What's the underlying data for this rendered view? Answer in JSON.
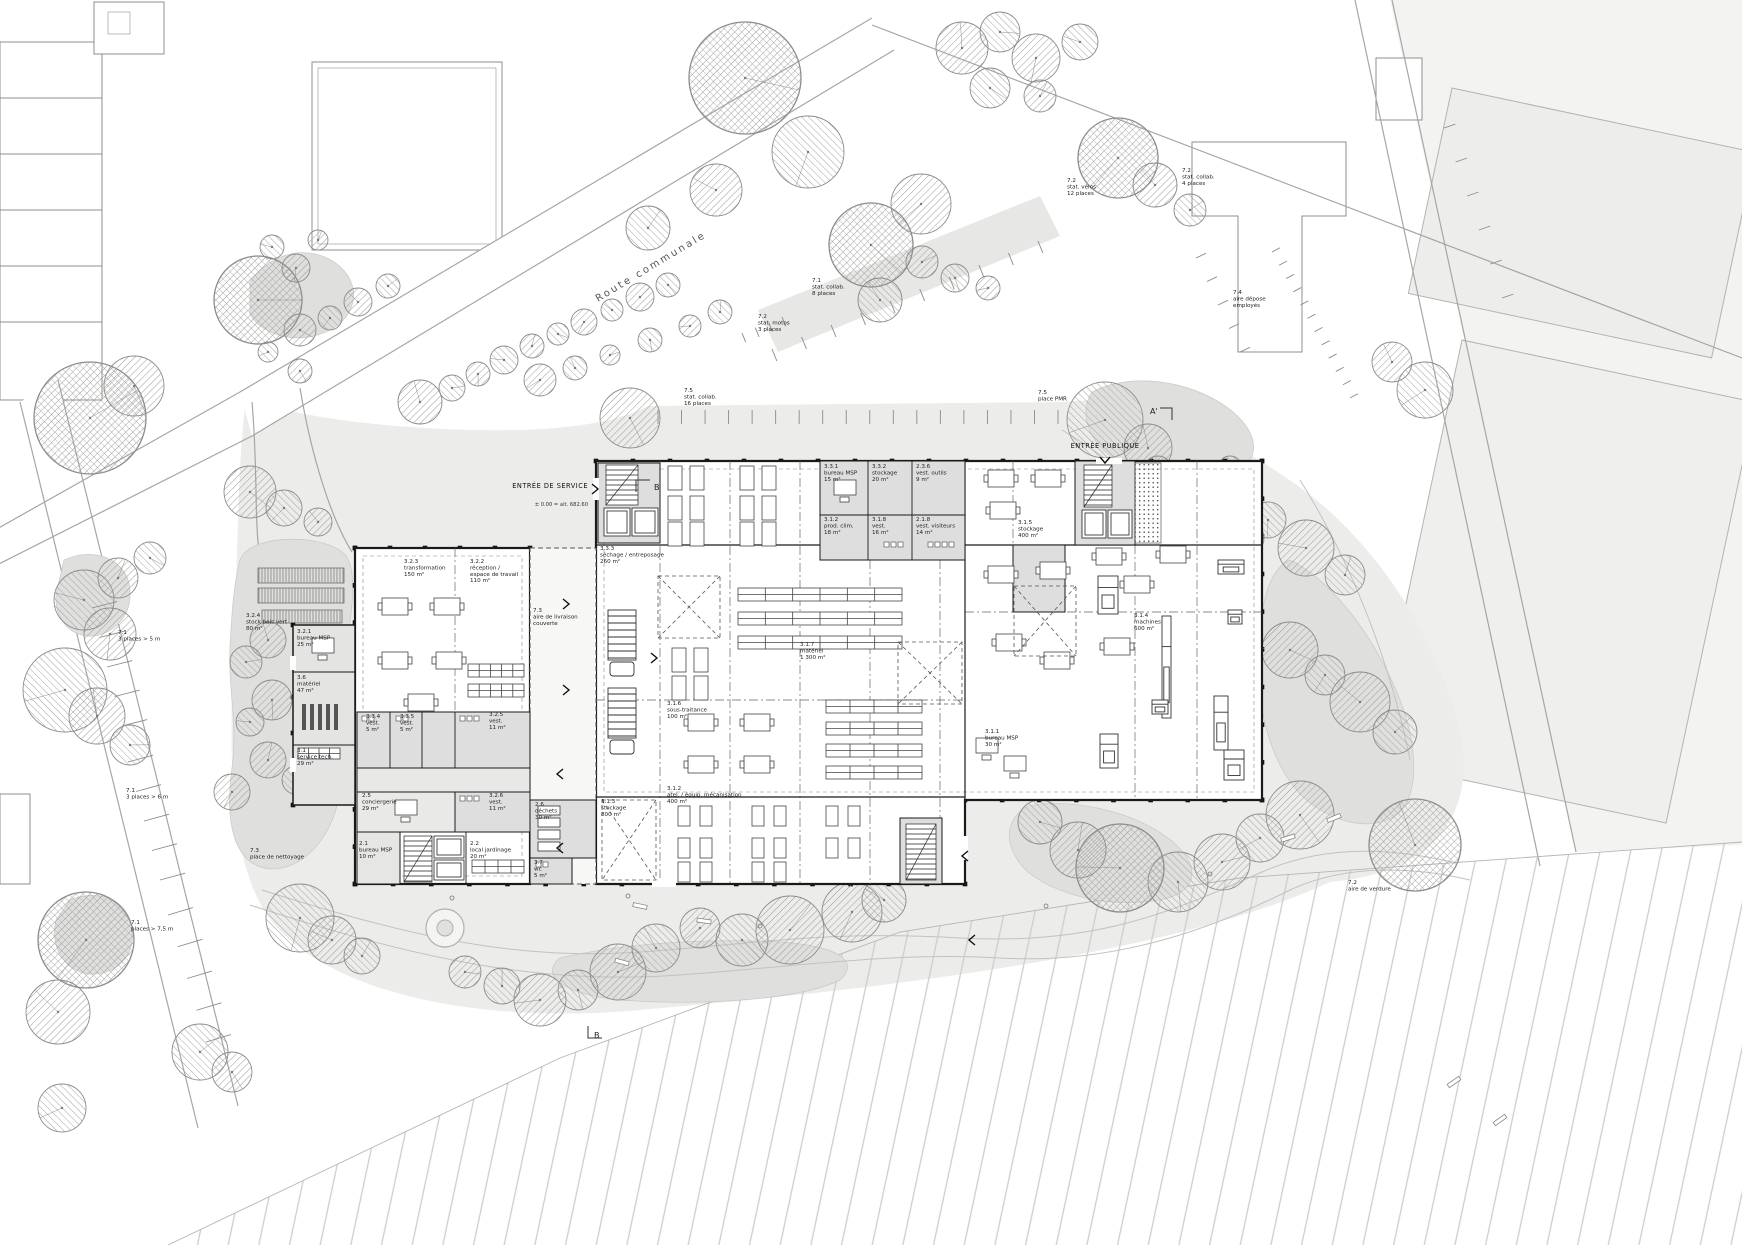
{
  "title": "Plan de situation — rez-de-chaussée",
  "colors": {
    "paper": "#ffffff",
    "building_line": "#1a1a1a",
    "room_fill": "#dedede",
    "landscape_fill": "#ececea",
    "green_patch": "#dfdfdd",
    "tree_stroke": "#8c8c8a"
  },
  "labels": {
    "rooms": [
      {
        "x": 600,
        "y": 550,
        "lines": [
          "3.3.3",
          "séchage / entreposage",
          "260 m²"
        ]
      },
      {
        "x": 404,
        "y": 563,
        "lines": [
          "3.2.3",
          "transformation",
          "150 m²"
        ]
      },
      {
        "x": 470,
        "y": 563,
        "lines": [
          "3.2.2",
          "réception /",
          "espace de travail",
          "110 m²"
        ]
      },
      {
        "x": 246,
        "y": 617,
        "lines": [
          "3.2.4",
          "stock bois vert",
          "80 m²"
        ]
      },
      {
        "x": 297,
        "y": 633,
        "lines": [
          "3.2.1",
          "bureau MSP",
          "25 m²"
        ]
      },
      {
        "x": 297,
        "y": 679,
        "lines": [
          "3.6",
          "matériel",
          "47 m²"
        ]
      },
      {
        "x": 297,
        "y": 752,
        "lines": [
          "3.1",
          "service tech.",
          "29 m²"
        ]
      },
      {
        "x": 366,
        "y": 718,
        "lines": [
          "3.3.4",
          "vest.",
          "5 m²"
        ]
      },
      {
        "x": 400,
        "y": 718,
        "lines": [
          "3.3.5",
          "vest.",
          "5 m²"
        ]
      },
      {
        "x": 489,
        "y": 716,
        "lines": [
          "3.2.5",
          "vest.",
          "11 m²"
        ]
      },
      {
        "x": 489,
        "y": 797,
        "lines": [
          "3.2.6",
          "vest.",
          "11 m²"
        ]
      },
      {
        "x": 362,
        "y": 797,
        "lines": [
          "2.5",
          "conciergerie",
          "29 m²"
        ]
      },
      {
        "x": 359,
        "y": 845,
        "lines": [
          "2.1",
          "bureau MSP",
          "10 m²"
        ]
      },
      {
        "x": 470,
        "y": 845,
        "lines": [
          "2.2",
          "local jardinage",
          "20 m²"
        ]
      },
      {
        "x": 601,
        "y": 803,
        "lines": [
          "3.1.3",
          "stockage",
          "800 m²"
        ]
      },
      {
        "x": 535,
        "y": 806,
        "lines": [
          "2.6",
          "déchets",
          "30 m²"
        ]
      },
      {
        "x": 534,
        "y": 864,
        "lines": [
          "3.7",
          "wc",
          "5 m²"
        ]
      },
      {
        "x": 824,
        "y": 468,
        "lines": [
          "3.3.1",
          "bureau MSP",
          "15 m²"
        ]
      },
      {
        "x": 872,
        "y": 468,
        "lines": [
          "3.3.2",
          "stockage",
          "20 m²"
        ]
      },
      {
        "x": 916,
        "y": 468,
        "lines": [
          "2.3.6",
          "vest. outils",
          "9 m²"
        ]
      },
      {
        "x": 824,
        "y": 521,
        "lines": [
          "3.1.2",
          "prod. clim.",
          "18 m²"
        ]
      },
      {
        "x": 872,
        "y": 521,
        "lines": [
          "3.1.8",
          "vest.",
          "16 m²"
        ]
      },
      {
        "x": 916,
        "y": 521,
        "lines": [
          "2.1.8",
          "vest. visiteurs",
          "14 m²"
        ]
      },
      {
        "x": 1018,
        "y": 524,
        "lines": [
          "3.1.5",
          "stockage",
          "400 m²"
        ]
      },
      {
        "x": 800,
        "y": 646,
        "lines": [
          "3.1.7",
          "matériel",
          "1 300 m²"
        ]
      },
      {
        "x": 667,
        "y": 705,
        "lines": [
          "3.1.6",
          "sous-traitance",
          "100 m²"
        ]
      },
      {
        "x": 667,
        "y": 790,
        "lines": [
          "3.1.2",
          "atel. / équip. mécanisation",
          "400 m²"
        ]
      },
      {
        "x": 1134,
        "y": 617,
        "lines": [
          "3.1.4",
          "machines",
          "600 m²"
        ]
      },
      {
        "x": 985,
        "y": 733,
        "lines": [
          "3.1.1",
          "bureau MSP",
          "30 m²"
        ]
      }
    ],
    "site": [
      {
        "x": 812,
        "y": 282,
        "lines": [
          "7.1",
          "stat. collab.",
          "8 places"
        ]
      },
      {
        "x": 758,
        "y": 318,
        "lines": [
          "7.2",
          "stat. motos",
          "3 places"
        ]
      },
      {
        "x": 1067,
        "y": 182,
        "lines": [
          "7.2",
          "stat. vélos",
          "12 places"
        ]
      },
      {
        "x": 1182,
        "y": 172,
        "lines": [
          "7.2",
          "stat. collab.",
          "4 places"
        ]
      },
      {
        "x": 1233,
        "y": 294,
        "lines": [
          "7.4",
          "aire dépose",
          "employés"
        ]
      },
      {
        "x": 684,
        "y": 392,
        "lines": [
          "7.5",
          "stat. collab.",
          "16 places"
        ]
      },
      {
        "x": 1038,
        "y": 394,
        "lines": [
          "7.5",
          "place PMR"
        ]
      },
      {
        "x": 533,
        "y": 612,
        "lines": [
          "7.3",
          "aire de livraison",
          "couverte"
        ]
      },
      {
        "x": 250,
        "y": 852,
        "lines": [
          "7.3",
          "place de nettoyage"
        ]
      },
      {
        "x": 1348,
        "y": 884,
        "lines": [
          "7.2",
          "aire de verdure"
        ]
      },
      {
        "x": 118,
        "y": 634,
        "lines": [
          "7.1",
          "3 places > 5 m"
        ]
      },
      {
        "x": 126,
        "y": 792,
        "lines": [
          "7.1",
          "3 places > 6 m"
        ]
      },
      {
        "x": 131,
        "y": 924,
        "lines": [
          "7.1",
          "places > 7,5 m"
        ]
      }
    ],
    "special": [
      {
        "x": 598,
        "y": 302,
        "rot": -31,
        "cls": "road",
        "lines": [
          "Route communale"
        ]
      },
      {
        "x": 588,
        "y": 488,
        "anchor": "end",
        "cls": "entry",
        "lines": [
          "ENTRÉE DE SERVICE"
        ]
      },
      {
        "x": 588,
        "y": 506,
        "anchor": "end",
        "cls": "small",
        "lines": [
          "± 0.00 = alt. 682.60"
        ]
      },
      {
        "x": 1105,
        "y": 448,
        "anchor": "middle",
        "cls": "entry",
        "lines": [
          "ENTRÉE PUBLIQUE"
        ]
      },
      {
        "x": 654,
        "y": 490,
        "cls": "marker",
        "lines": [
          "B"
        ]
      },
      {
        "x": 594,
        "y": 1038,
        "cls": "marker",
        "lines": [
          "B"
        ]
      },
      {
        "x": 1150,
        "y": 414,
        "cls": "marker",
        "lines": [
          "A'"
        ]
      }
    ]
  }
}
